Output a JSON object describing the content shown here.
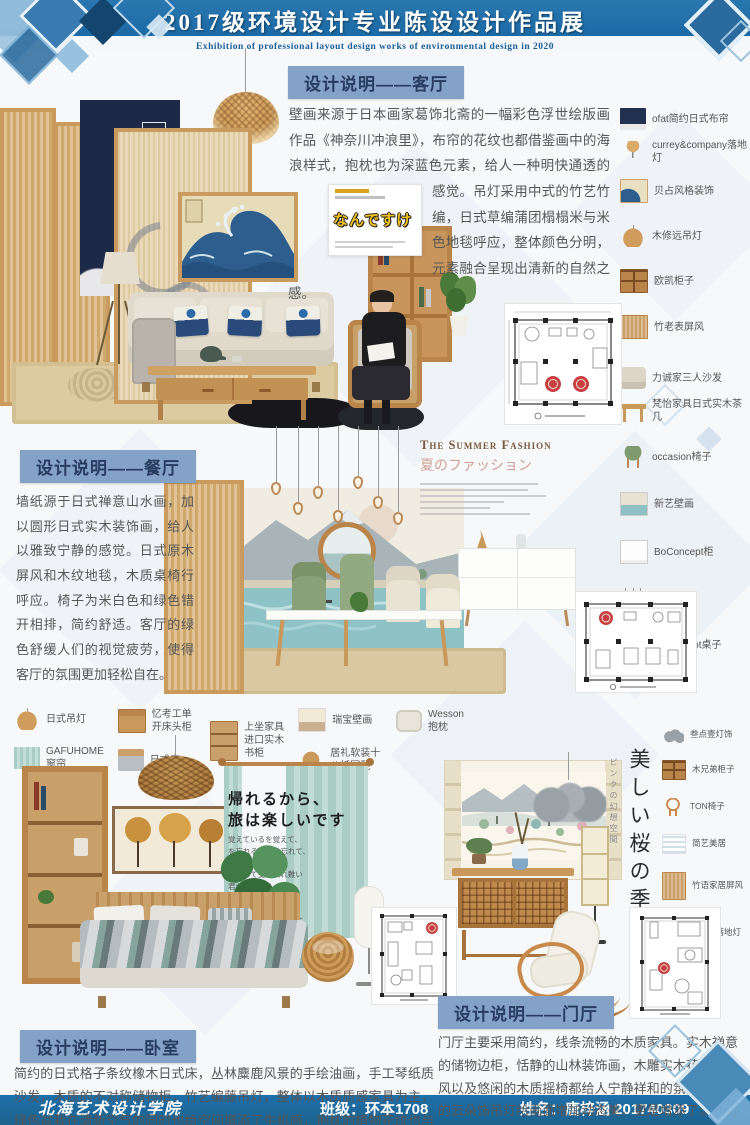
{
  "header": {
    "title": "2017级环境设计专业陈设设计作品展",
    "subtitle": "Exhibition of professional layout design works of environmental design in 2020"
  },
  "footer": {
    "school": "北海艺术设计学院",
    "class": "班级：环本1708",
    "name": "姓名：唐梓涵 201740309"
  },
  "colors": {
    "banner_blue": "#1c6aa6",
    "badge_blue": "#84a1c8",
    "plan_accent_red": "#c84040"
  },
  "sections": {
    "living": {
      "badge": "设计说明——客厅",
      "body": "壁画来源于日本画家葛饰北斋的一幅彩色浮世绘版画作品《神奈川冲浪里》，布帘的花纹也都借鉴画中的海浪样式，抱枕也为深蓝色元素，给人一种明快通透的感觉。吊灯采用中式的竹艺竹编，日式草编蒲团榻榻米与米色地毯呼应，整体颜色分明，元素融合呈现出清新的自然之感。",
      "magazine_title": "なんですけ",
      "items": [
        {
          "icon": "navy-curtain-thumb",
          "label": "ofat简约日式布帘"
        },
        {
          "icon": "floor-lamp-thumb",
          "label": "currey&company落地灯"
        },
        {
          "icon": "wave-art-thumb",
          "label": "贝占风格装饰"
        },
        {
          "icon": "rattan-pendant-thumb",
          "label": "木修远吊灯"
        },
        {
          "icon": "cabinet-thumb",
          "label": "欧凯柜子"
        },
        {
          "icon": "bamboo-screen-thumb",
          "label": "竹老表屏风"
        },
        {
          "icon": "sofa-thumb",
          "label": "力诚家三人沙发"
        },
        {
          "icon": "coffee-table-thumb",
          "label": "梵怡家具日式实木茶几"
        }
      ]
    },
    "dining": {
      "badge": "设计说明——餐厅",
      "body": "墙纸源于日式禅意山水画，加以圆形日式实木装饰画，给人以雅致宁静的感觉。日式原木屏风和木纹地毯，木质桌椅行呼应。椅子为米白色和绿色错开相排，简约舒适。客厅的绿色舒缓人们的视觉疲劳，使得客厅的氛围更加轻松自在。",
      "deco_title_en": "The Summer Fashion",
      "deco_title_jp": "夏のファッション",
      "items": [
        {
          "icon": "green-chair-thumb",
          "label": "occasion椅子"
        },
        {
          "icon": "landscape-art-thumb",
          "label": "新艺壁画"
        },
        {
          "icon": "sideboard-thumb",
          "label": "BoConcept柜"
        },
        {
          "icon": "glass-pendant-thumb",
          "label": "玻璃吊灯"
        },
        {
          "icon": "dining-table-thumb",
          "label": "BoConcept桌子"
        }
      ]
    },
    "bedroom": {
      "badge": "设计说明——卧室",
      "body": "简约的日式格子条纹橡木日式床，丛林麋鹿风景的手绘油画，手工琴纸质沙发，木质的不对称储物柜，竹艺编藤吊灯，整体以木质质感家具为主，绿色盆栽在清新空气的同时也给空间增添了生机感，抱枕的植物花纹也与之呼应。",
      "poem_title_1": "帰れるから、",
      "poem_title_2": "旅は楽しいです",
      "poem_lines": [
        "覚えているを覚えて、",
        "を忘れることは忘れて、",
        "変更を変更し、",
        "同意して受け入れ難い",
        "君がいるから、",
        "今の僕は、幸せです",
        "どうも",
        "ありがとうございます"
      ],
      "items": [
        {
          "icon": "rattan-pendant-thumb",
          "label": "日式吊灯"
        },
        {
          "icon": "teal-curtain-thumb",
          "label": "GAFUHOME窗帘"
        },
        {
          "icon": "nightstand-thumb",
          "label": "忆考工单开床头柜"
        },
        {
          "icon": "bed-thumb",
          "label": "日式床"
        },
        {
          "icon": "bookcase-thumb",
          "label": "上坐家具进口实木书柜"
        },
        {
          "icon": "mural-thumb",
          "label": "瑞宝壁画"
        },
        {
          "icon": "round-stool-thumb",
          "label": "居礼软装十八纸圆凳"
        },
        {
          "icon": "pillow-thumb",
          "label": "Wesson抱枕"
        }
      ]
    },
    "hall": {
      "badge": "设计说明——门厅",
      "body": "门厅主要采用简约，线条流畅的木质家具。实木禅意的储物边柜，恬静的山林装饰画，木雕实木花格的屏风以及悠闲的木质摇椅都给人宁静祥和的氛围，灰色的云朵饰吊灯给画面增加动态美，更是增添了淡雅的感觉。",
      "vertical_title": "美しい桜の季節",
      "vertical_sub": "ピンクの幻想空間",
      "items": [
        {
          "icon": "cloud-lamp-thumb",
          "label": "叁点壹灯饰"
        },
        {
          "icon": "cabinet-thumb",
          "label": "木兄弟柜子"
        },
        {
          "icon": "rattan-chair-thumb",
          "label": "TON椅子"
        },
        {
          "icon": "soft-decor-thumb",
          "label": "简艺美居"
        },
        {
          "icon": "bamboo-screen-thumb",
          "label": "竹语家居屏风"
        },
        {
          "icon": "paper-floor-lamp-thumb",
          "label": "最灯饰落地灯"
        }
      ]
    }
  }
}
